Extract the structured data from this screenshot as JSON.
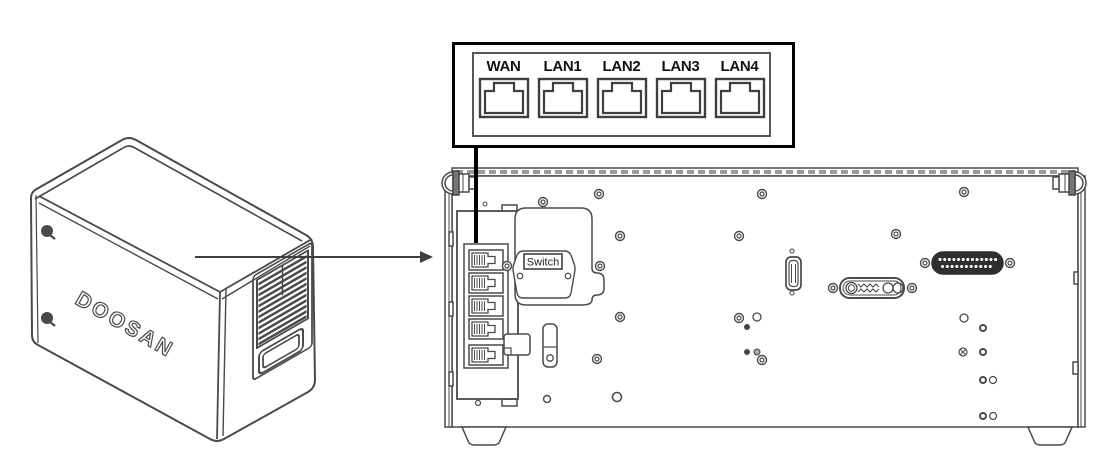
{
  "callout": {
    "ports": [
      {
        "label": "WAN"
      },
      {
        "label": "LAN1"
      },
      {
        "label": "LAN2"
      },
      {
        "label": "LAN3"
      },
      {
        "label": "LAN4"
      }
    ]
  },
  "device": {
    "brand": "DOOSAN"
  },
  "back_panel": {
    "switch_label": "Switch"
  },
  "icons": {
    "port_front": "rj45-port-icon",
    "port_side": "rj45-side-icon",
    "screw": "screw-icon",
    "arrow": "arrow-right-icon"
  },
  "colors": {
    "line": "#4a4a4a",
    "callout_border": "#000000",
    "label_text": "#111111",
    "connector_dark": "#2f2f2f"
  }
}
